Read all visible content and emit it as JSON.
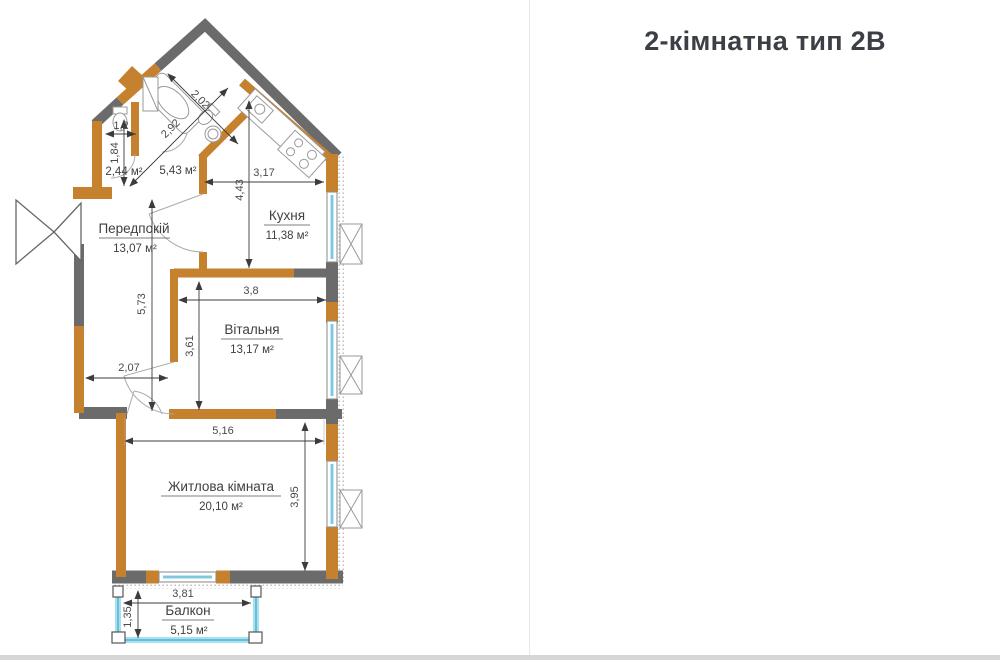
{
  "plan": {
    "rooms": {
      "hallway": {
        "name": "Передпокій",
        "area": "13,07 м²"
      },
      "kitchen": {
        "name": "Кухня",
        "area": "11,38 м²"
      },
      "living": {
        "name": "Вітальня",
        "area": "13,17 м²"
      },
      "bedroom": {
        "name": "Житлова кімната",
        "area": "20,10 м²"
      },
      "balcony": {
        "name": "Балкон",
        "area": "5,15 м²"
      },
      "bathroom": {
        "area": "5,43 м²"
      },
      "wc": {
        "area": "2,44 м²"
      }
    },
    "dims": {
      "d202": "2,02",
      "d292": "2,92",
      "d12": "1,2",
      "d184": "1,84",
      "d443": "4,43",
      "d317": "3,17",
      "d573": "5,73",
      "d38": "3,8",
      "d361": "3,61",
      "d207": "2,07",
      "d516": "5,16",
      "d395": "3,95",
      "d381": "3,81",
      "d135": "1,35"
    },
    "colors": {
      "wall_orange": "#c6812f",
      "wall_gray": "#6b6b6b",
      "window_cyan": "#bfe7f2"
    }
  },
  "panel": {
    "title": "2-кімнатна тип 2В",
    "summary": [
      {
        "label": "ЗАГАЛЬНА ПЛ.",
        "value": "67,16 м²"
      },
      {
        "label": "ЖИТЛОВА ПЛ.",
        "value": "33,27 м²"
      }
    ],
    "rooms": [
      {
        "num": "1.",
        "name": "Передпокій",
        "area": "13,07 м²"
      },
      {
        "num": "2.",
        "name": "Кухня",
        "area": "11,38 м²"
      },
      {
        "num": "3.",
        "name": "Вітальня",
        "area": "13,17 м²"
      },
      {
        "num": "4.",
        "name": "Житлова кімната",
        "area": "20,10 м²"
      },
      {
        "num": "5.",
        "name": "Санвузол",
        "area": "5,45 м²"
      },
      {
        "num": "6.",
        "name": "Санвузол",
        "area": "2,44 м²"
      },
      {
        "num": "7.",
        "name": "Лоджия",
        "area": "5,15 м²"
      }
    ],
    "site": {
      "street_top": "вул.Живописна",
      "street_left": "вул.Львівська",
      "section1": "секція 1",
      "section2": "секція 2"
    }
  }
}
